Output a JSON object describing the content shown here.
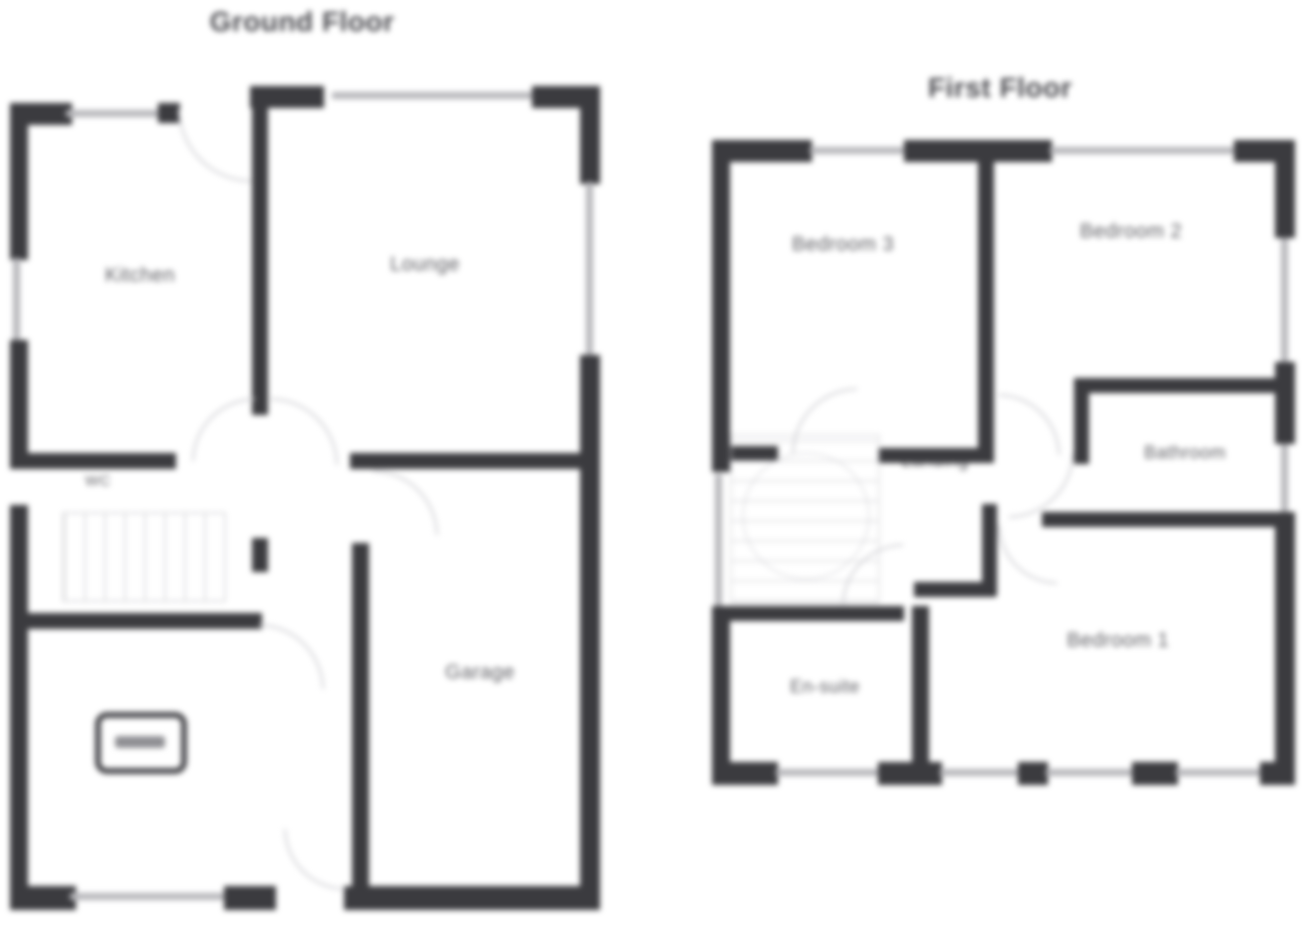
{
  "ground_floor": {
    "title": "Ground Floor",
    "rooms": {
      "kitchen": "Kitchen",
      "lounge": "Lounge",
      "wc": "WC",
      "garage": "Garage"
    }
  },
  "first_floor": {
    "title": "First Floor",
    "rooms": {
      "bedroom3": "Bedroom 3",
      "bedroom2": "Bedroom 2",
      "bedroom1": "Bedroom 1",
      "bathroom": "Bathroom",
      "landing": "Landing",
      "ensuite": "En-suite"
    }
  },
  "colors": {
    "wall": "#3b3b3f",
    "window_line": "#b6b6ba",
    "label": "#5d5d62",
    "faint": "#cfcfd3",
    "background": "#ffffff"
  }
}
